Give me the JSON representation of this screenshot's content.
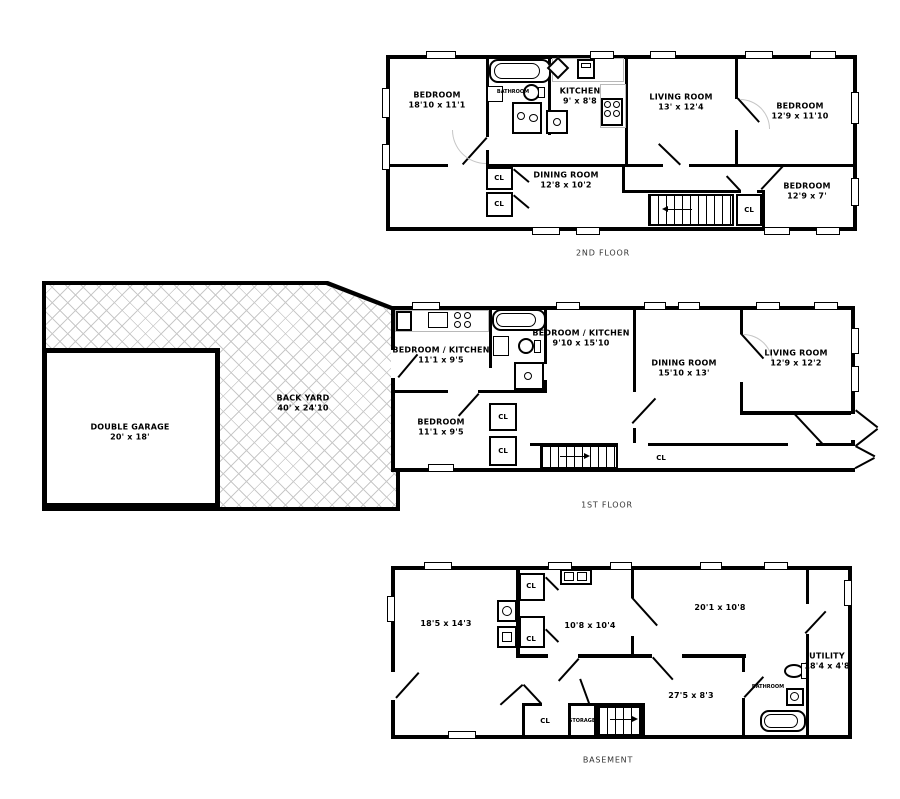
{
  "colors": {
    "wall": "#000000",
    "background": "#ffffff",
    "hatch_line": "#c9c9c9"
  },
  "floors": {
    "second": {
      "caption": "2ND FLOOR",
      "rooms": {
        "bedroom1": {
          "name": "BEDROOM",
          "dims": "18'10 x 11'1"
        },
        "bathroom": {
          "name": "BATHROOM"
        },
        "kitchen": {
          "name": "KITCHEN",
          "dims": "9' x 8'8"
        },
        "living": {
          "name": "LIVING ROOM",
          "dims": "13' x 12'4"
        },
        "bedroom2": {
          "name": "BEDROOM",
          "dims": "12'9 x 11'10"
        },
        "dining": {
          "name": "DINING ROOM",
          "dims": "12'8 x 10'2"
        },
        "bedroom3": {
          "name": "BEDROOM",
          "dims": "12'9 x 7'"
        },
        "closet1": {
          "label": "CL"
        },
        "closet2": {
          "label": "CL"
        },
        "closet3": {
          "label": "CL"
        }
      }
    },
    "first": {
      "caption": "1ST FLOOR",
      "rooms": {
        "backyard": {
          "name": "BACK YARD",
          "dims": "40' x 24'10"
        },
        "garage": {
          "name": "DOUBLE GARAGE",
          "dims": "20' x 18'"
        },
        "bedroom_kitchen1": {
          "name": "BEDROOM / KITCHEN",
          "dims": "11'1 x 9'5"
        },
        "bedroom_kitchen2": {
          "name": "BEDROOM / KITCHEN",
          "dims": "9'10 x 15'10"
        },
        "bedroom": {
          "name": "BEDROOM",
          "dims": "11'1 x 9'5"
        },
        "dining": {
          "name": "DINING ROOM",
          "dims": "15'10 x 13'"
        },
        "living": {
          "name": "LIVING ROOM",
          "dims": "12'9 x 12'2"
        },
        "closet1": {
          "label": "CL"
        },
        "closet2": {
          "label": "CL"
        },
        "closet3": {
          "label": "CL"
        }
      }
    },
    "basement": {
      "caption": "BASEMENT",
      "rooms": {
        "rec_room": {
          "dims": "18'5 x 14'3"
        },
        "room2": {
          "dims": "10'8 x 10'4"
        },
        "room3": {
          "dims": "20'1 x 10'8"
        },
        "room4": {
          "dims": "27'5 x 8'3"
        },
        "utility": {
          "name": "UTILITY",
          "dims": "18'4 x 4'8"
        },
        "bathroom": {
          "name": "BATHROOM"
        },
        "storage": {
          "label": "STORAGE"
        },
        "closet1": {
          "label": "CL"
        },
        "closet2": {
          "label": "CL"
        },
        "closet3": {
          "label": "CL"
        }
      }
    }
  }
}
